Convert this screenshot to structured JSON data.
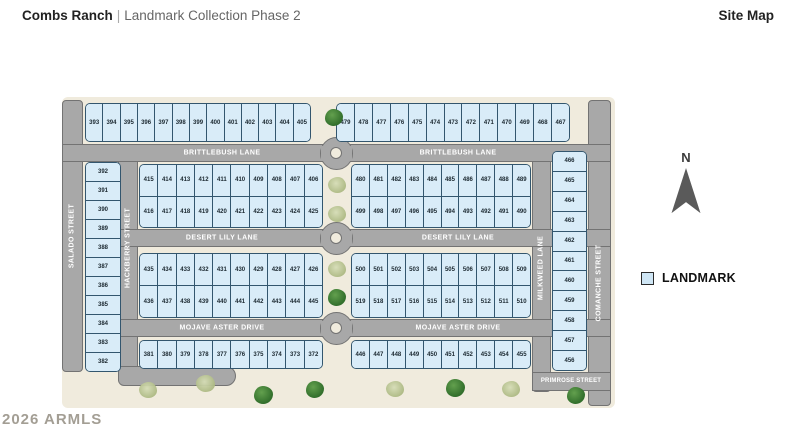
{
  "header": {
    "community": "Combs Ranch",
    "separator": "|",
    "subtitle": "Landmark Collection Phase 2",
    "page_label": "Site Map"
  },
  "watermark": "2026 ARMLS",
  "compass": {
    "label": "N"
  },
  "legend": {
    "label": "LANDMARK",
    "swatch_color": "#cfe6f5"
  },
  "streets": {
    "brittlebush": "BRITTLEBUSH LANE",
    "desert_lily": "DESERT LILY LANE",
    "mojave_aster": "MOJAVE ASTER DRIVE",
    "salado": "SALADO STREET",
    "hackberry": "HACKBERRY STREET",
    "milkweed": "MILKWEED LANE",
    "comanche": "COMANCHE STREET",
    "primrose": "PRIMROSE STREET"
  },
  "colors": {
    "lot_fill": "#d9ecf8",
    "lot_border": "#33566e",
    "road": "#a8a8a8",
    "road_border": "#737373",
    "land": "#f0ebdd"
  },
  "lots": {
    "top_left": [
      "393",
      "394",
      "395",
      "396",
      "397",
      "398",
      "399",
      "400",
      "401",
      "402",
      "403",
      "404",
      "405"
    ],
    "top_right": [
      "479",
      "478",
      "477",
      "476",
      "475",
      "474",
      "473",
      "472",
      "471",
      "470",
      "469",
      "468",
      "467"
    ],
    "west_column": [
      "392",
      "391",
      "390",
      "389",
      "388",
      "387",
      "386",
      "385",
      "384",
      "383",
      "382"
    ],
    "east_column": [
      "466",
      "465",
      "464",
      "463",
      "462",
      "461",
      "460",
      "459",
      "458",
      "457",
      "456"
    ],
    "block_a_row1": [
      "415",
      "414",
      "413",
      "412",
      "411",
      "410",
      "409",
      "408",
      "407",
      "406"
    ],
    "block_a_row2": [
      "416",
      "417",
      "418",
      "419",
      "420",
      "421",
      "422",
      "423",
      "424",
      "425"
    ],
    "block_b_row1": [
      "480",
      "481",
      "482",
      "483",
      "484",
      "485",
      "486",
      "487",
      "488",
      "489"
    ],
    "block_b_row2": [
      "499",
      "498",
      "497",
      "496",
      "495",
      "494",
      "493",
      "492",
      "491",
      "490"
    ],
    "block_c_row1": [
      "435",
      "434",
      "433",
      "432",
      "431",
      "430",
      "429",
      "428",
      "427",
      "426"
    ],
    "block_c_row2": [
      "436",
      "437",
      "438",
      "439",
      "440",
      "441",
      "442",
      "443",
      "444",
      "445"
    ],
    "block_d_row1": [
      "500",
      "501",
      "502",
      "503",
      "504",
      "505",
      "506",
      "507",
      "508",
      "509"
    ],
    "block_d_row2": [
      "519",
      "518",
      "517",
      "516",
      "515",
      "514",
      "513",
      "512",
      "511",
      "510"
    ],
    "bottom_left": [
      "381",
      "380",
      "379",
      "378",
      "377",
      "376",
      "375",
      "374",
      "373",
      "372"
    ],
    "bottom_right": [
      "446",
      "447",
      "448",
      "449",
      "450",
      "451",
      "452",
      "453",
      "454",
      "455"
    ]
  }
}
